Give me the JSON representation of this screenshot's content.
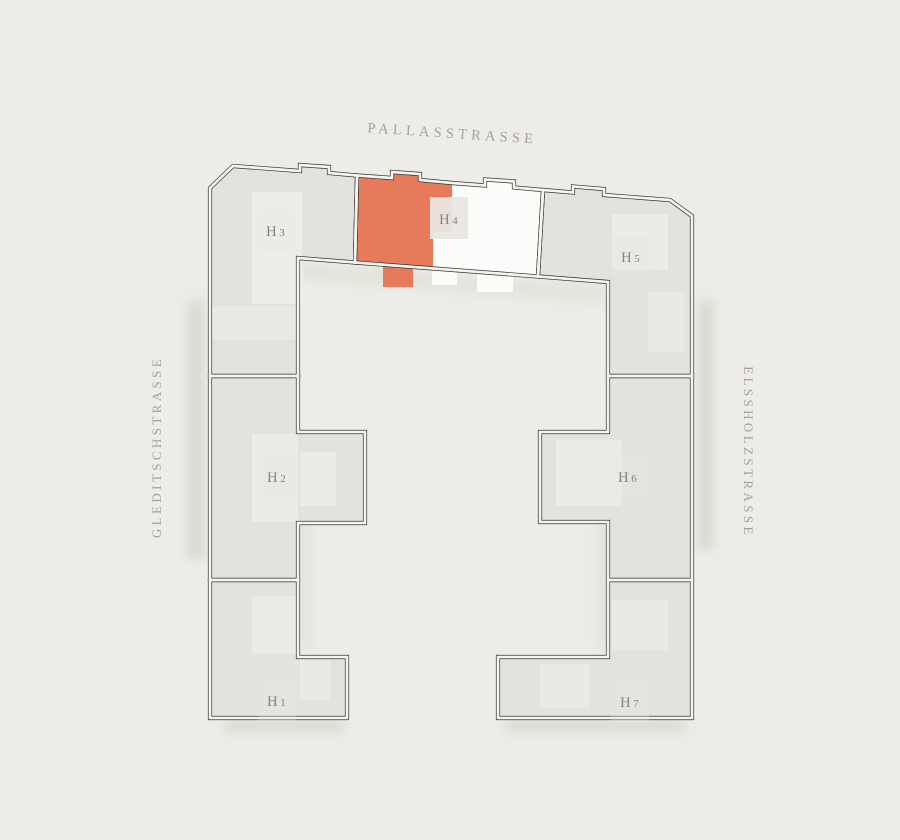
{
  "page": {
    "background": "#edece6",
    "title": "Site plan building selector"
  },
  "streets": {
    "top": {
      "name": "PALLASSTRASSE"
    },
    "left": {
      "name": "GLEDITSCHSTRASSE"
    },
    "right": {
      "name": "ELSSHOLZSTRASSE"
    }
  },
  "plan": {
    "colors": {
      "building": "#e3e2dd",
      "unit_light": "#fbfbfa",
      "unit_selected": "#e87a5c",
      "outline": "#333331",
      "outline_gap": "#f4f3ef",
      "label": "#84837d",
      "label_patch": "#e8e7e2",
      "street_label": "#a3a199"
    },
    "houses": [
      {
        "id": "h3",
        "label": "H3",
        "state": "default",
        "points": "210,188 233,166 300,171 300,165 329,167 329,173 357,175.5 355,262.5 298,258 298,376 210,376",
        "label_pos": [
          276,
          236
        ],
        "patch_opacity": 0.3
      },
      {
        "id": "h4",
        "label": "H4",
        "state": "light",
        "points": "357,175.5 392,178 392,172 420,174 420,180 452,183 485,185.5 485,179.5 514,181.5 514,187.5 543,190 538,276.5 355,262.5",
        "label_pos": [
          449,
          224
        ],
        "patch_opacity": 0.95,
        "overlays": [
          {
            "state": "selected",
            "points": "357,175.5 392,178 392,172 420,174 420,180 452,183 452,232 433,232 433,268.5 413,267 413,287 383,287 383,264.5 355,262.5"
          },
          {
            "state": "light",
            "points": "432,266.5 457,268.5 457,285 432,285"
          },
          {
            "state": "light",
            "points": "477,270 513,273 513,292 477,292"
          }
        ]
      },
      {
        "id": "h5",
        "label": "H5",
        "state": "default",
        "points": "543,190 573,192.5 573,186.5 604,189 604,195 670,200 692,216 692,376 608,376 608,282 538,276.5",
        "label_pos": [
          631,
          262
        ],
        "patch_opacity": 0.3
      },
      {
        "id": "h2",
        "label": "H2",
        "state": "default",
        "points": "210,376 298,376 298,432 365,432 365,523 298,523 298,580 210,580",
        "label_pos": [
          277,
          482
        ],
        "patch_opacity": 0.3
      },
      {
        "id": "h6",
        "label": "H6",
        "state": "default",
        "points": "608,376 692,376 692,580 608,580 608,522 540,522 540,432 608,432",
        "label_pos": [
          628,
          482
        ],
        "patch_opacity": 0.3
      },
      {
        "id": "h1",
        "label": "H1",
        "state": "default",
        "points": "210,580 298,580 298,657 347,657 347,718 210,718",
        "label_pos": [
          277,
          706
        ],
        "patch_opacity": 0.3
      },
      {
        "id": "h7",
        "label": "H7",
        "state": "default",
        "points": "608,580 692,580 692,718 498,718 498,657 608,657",
        "label_pos": [
          630,
          707
        ],
        "patch_opacity": 0.3
      }
    ]
  }
}
